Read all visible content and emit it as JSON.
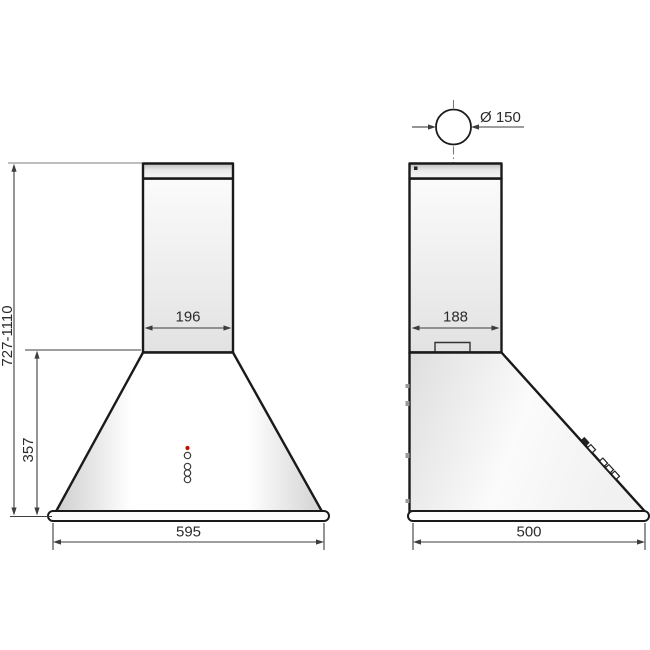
{
  "drawing": {
    "front_view": {
      "chimney_width_label": "196",
      "base_width_label": "595",
      "cone_height_label": "357",
      "total_height_label": "727-1110"
    },
    "side_view": {
      "chimney_depth_label": "188",
      "base_depth_label": "500",
      "duct_diameter_label": "Ø 150"
    }
  },
  "colors": {
    "outline": "#1a1a1a",
    "dimension": "#3d3d3d",
    "reference": "#a8a8a8",
    "led": "#bb1100"
  }
}
